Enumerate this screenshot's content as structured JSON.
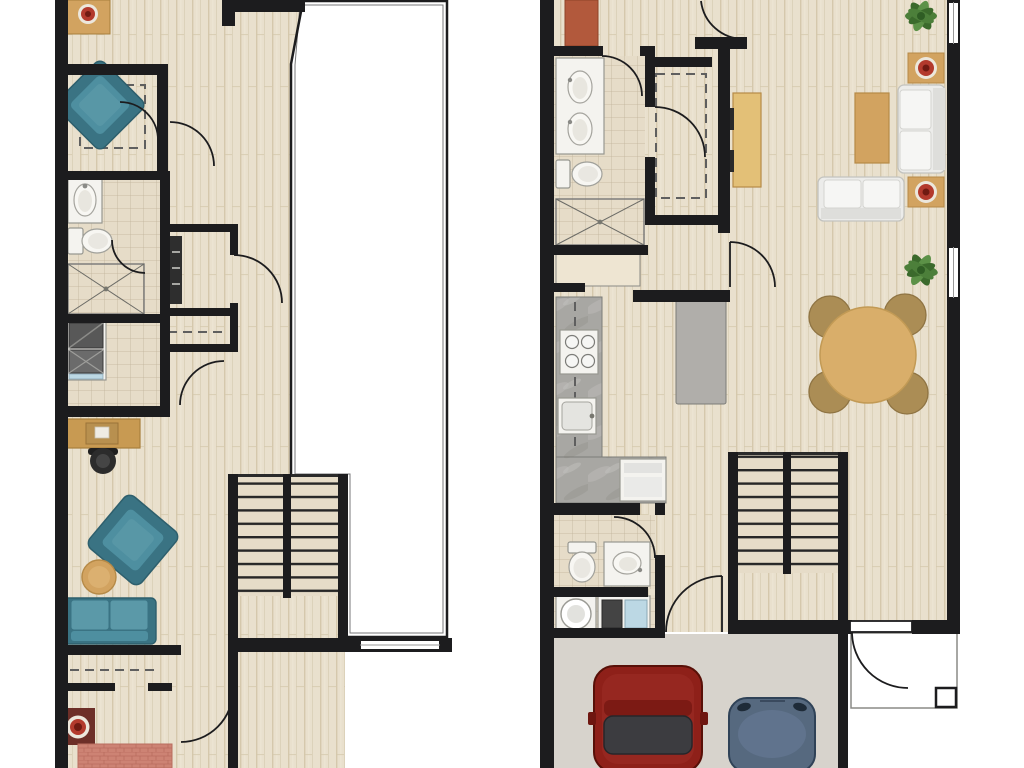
{
  "title": "Two-storey townhouse floor plans",
  "colors": {
    "wall": "#1c1c1e",
    "wood": "#e9e0cd",
    "woodStreak": "#d5c8ac",
    "tileBase": "#e6dcc8",
    "tileLine": "#b9ab92",
    "teal": "#4e8fa0",
    "tealDark": "#3a7383",
    "tealLight": "#5b99a8",
    "tan": "#d2a360",
    "tanDark": "#a87f3d",
    "plate_red": "#b33a2d",
    "plate_dark": "#701a12",
    "rug_red": "#6d2f28",
    "bed_salmon": "#cd8374",
    "bed_orange": "#b2593c",
    "marble": "#a8a7a3",
    "island": "#b0aeaa",
    "sofa_white": "#ececea",
    "plant_green": "#4c7f3a",
    "plant_dark": "#3b6a2c",
    "car_red": "#8e2019",
    "car_red_dark": "#581008",
    "car_blue": "#56697f",
    "car_blue_dark": "#2f4257",
    "garage_floor": "#d7d3cc",
    "appliance_dark": "#585858",
    "appliance_blue": "#bcd8e4"
  },
  "floors": {
    "upper": {
      "name": "Upper floor plan (left)",
      "rooms": [
        "Bedroom",
        "Walk-in closet",
        "Bathroom",
        "Laundry closet",
        "Hallway",
        "Den / office",
        "Bedroom 2",
        "Staircase",
        "Open to below"
      ],
      "furniture": {
        "nightstand": "Nightstand with decorative red bowl",
        "armchair_1": "Teal armchair",
        "closet_dashed": "Walk-in closet shelving (dashed)",
        "vanity": "Bathroom vanity sink",
        "toilet": "Toilet",
        "shower": "Tiled shower",
        "washer_dryer": "Stacked washer and dryer",
        "closet_shelves": "Hall closet with shelving",
        "wardrobe": "Wardrobe with hanging rod",
        "desk": "Desk with office chair",
        "armchair_2": "Teal armchair",
        "ottoman": "Round tan ottoman",
        "sofa": "Teal loveseat",
        "rug": "Dark red rug with round pouf",
        "bed": "Bed, partially shown",
        "stairs": "U-shaped staircase",
        "window": "Window in lower wall",
        "open_below": "Double-height open space"
      }
    },
    "main": {
      "name": "Main floor plan (right)",
      "rooms": [
        "Bedroom (partial)",
        "Bathroom",
        "Walk-in closet",
        "Hallway",
        "Kitchen",
        "Dining area",
        "Living room",
        "Powder room",
        "Laundry",
        "Stair hall",
        "Garage",
        "Entry porch"
      ],
      "furniture": {
        "bed_corner": "Bed corner, partially shown",
        "double_vanity": "Double vanity with two sinks",
        "toilet": "Toilet",
        "shower": "Tiled shower",
        "closet_dashed": "Walk-in closet hanging rod (dashed)",
        "dresser": "Tan dresser / console",
        "sofa_right": "White sofa (vertical)",
        "sofa_bottom": "White sofa (horizontal)",
        "coffee_table": "Tan coffee table",
        "side_table_top": "Side table with red decorative bowl",
        "side_table_bottom": "Side table with red decorative bowl",
        "plant_top": "Potted plant",
        "plant_mid": "Potted plant",
        "dining_set": "Round dining table with four chairs",
        "kitchen_counter": "L-shaped counter with range and sink",
        "island": "Kitchen island",
        "dishwasher": "Dishwasher",
        "niche": "Built-in counter niche",
        "powder_toilet": "Powder room toilet",
        "powder_vanity": "Powder room vanity",
        "washer": "Washer",
        "dryer": "Dryer with control panel",
        "stairs": "U-shaped staircase",
        "car_red": "Red car",
        "car_blue": "Blue car",
        "porch": "Entry porch with corner post",
        "window_top": "Window, right wall upper",
        "window_mid": "Window, right wall middle",
        "entry_door": "Entry door to porch"
      }
    }
  }
}
